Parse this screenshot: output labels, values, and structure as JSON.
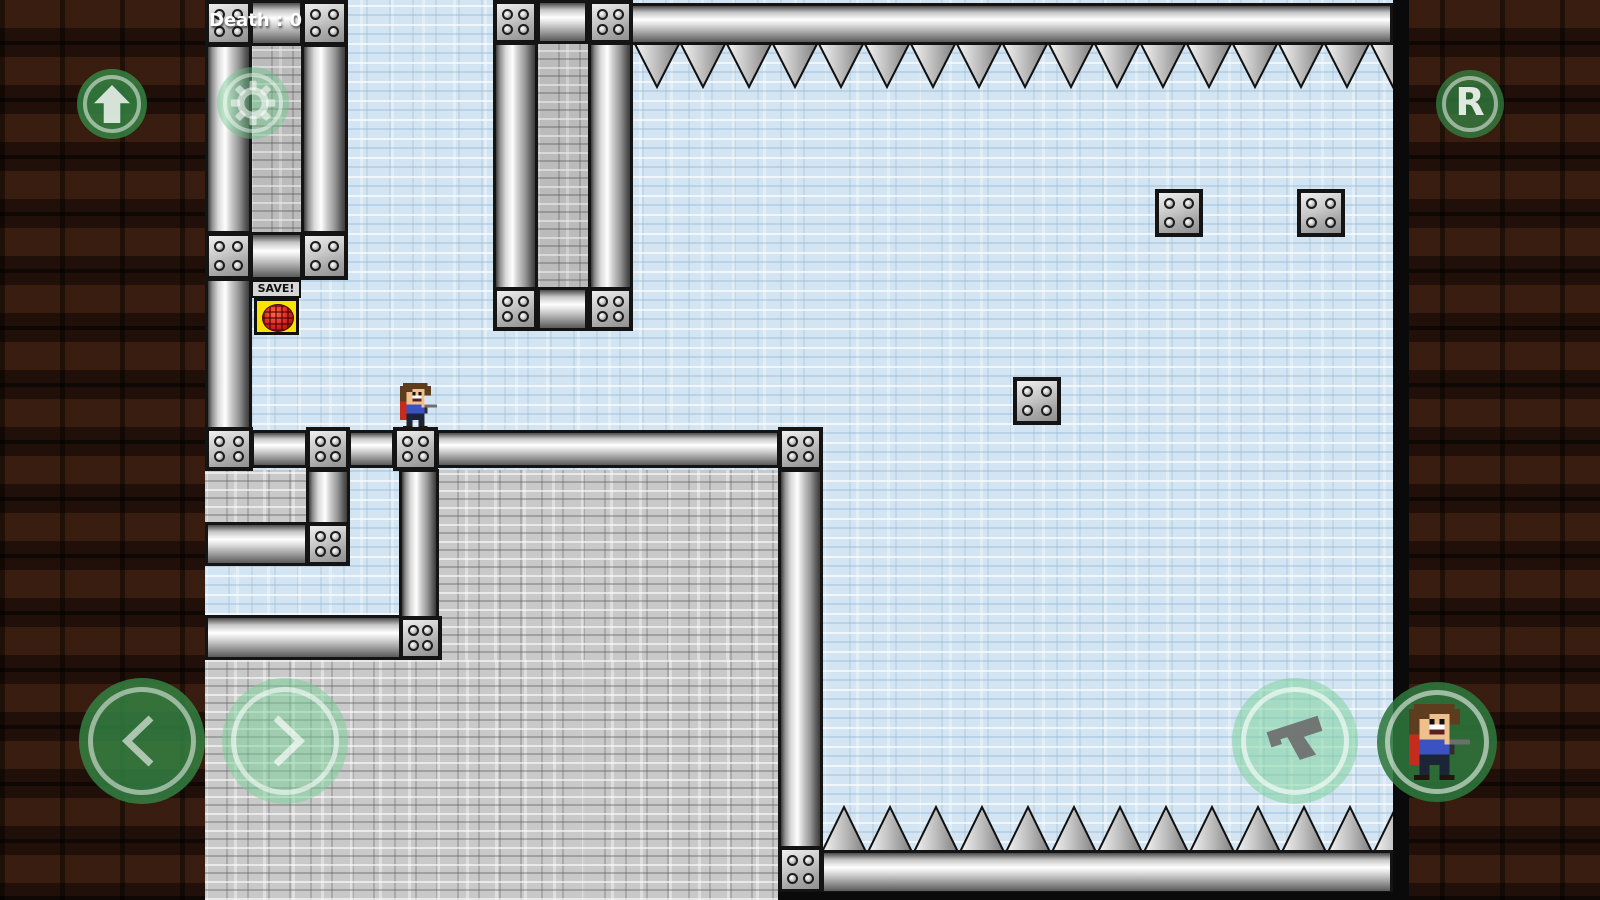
{
  "hud": {
    "death_counter": "Death : 0",
    "buttons": {
      "up": {
        "action": "jump",
        "icon": "arrow-up-icon"
      },
      "settings": {
        "action": "settings",
        "icon": "gear-icon"
      },
      "restart": {
        "action": "restart",
        "label": "R"
      },
      "left": {
        "action": "move-left",
        "icon": "chevron-left-icon"
      },
      "right": {
        "action": "move-right",
        "icon": "chevron-right-icon"
      },
      "shoot": {
        "action": "shoot",
        "icon": "pistol-icon"
      },
      "character": {
        "action": "character",
        "icon": "player-sprite-icon"
      }
    }
  },
  "level": {
    "save_point": {
      "label": "SAVE!"
    },
    "hazards": {
      "top": "ceiling-spikes",
      "bottom": "floor-spikes"
    },
    "player": {
      "sprite": "hero",
      "state": "standing-on-platform"
    }
  },
  "colors": {
    "button_green": "#388e4a",
    "play_background": "#d3e5f2",
    "brick_grey": "#c9c9c9",
    "dirt_brown": "#27140b",
    "save_yellow": "#f8e400",
    "save_red": "#d42020"
  }
}
